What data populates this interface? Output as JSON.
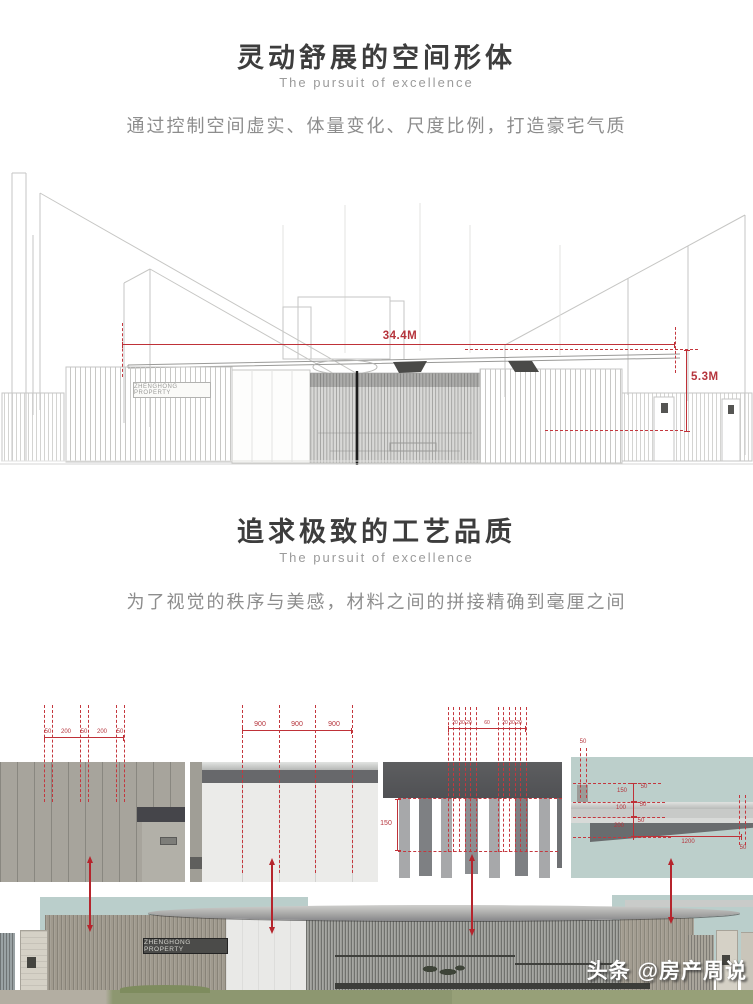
{
  "sections": [
    {
      "title": "灵动舒展的空间形体",
      "subtitle": "The pursuit of excellence",
      "description": "通过控制空间虚实、体量变化、尺度比例，打造豪宅气质"
    },
    {
      "title": "追求极致的工艺品质",
      "subtitle": "The pursuit of excellence",
      "description": "为了视觉的秩序与美感，材料之间的拼接精确到毫厘之间"
    }
  ],
  "figure1": {
    "sign": "ZHENGHONG PROPERTY",
    "dim_width": "34.4M",
    "dim_height": "5.3M"
  },
  "figure2": {
    "panel1_dims": [
      "50",
      "200",
      "50",
      "200",
      "50"
    ],
    "panel2_dims": [
      "900",
      "900",
      "900"
    ],
    "panel3_dims_top": [
      "20 30 20",
      "60",
      "20 30 20"
    ],
    "panel3_dim_height": "150",
    "panel4_dims": {
      "top": "50",
      "h1": "150",
      "s1": "50",
      "h2": "100",
      "s2": "50",
      "h3": "200",
      "s3": "50",
      "w": "1200",
      "b": "50"
    }
  },
  "elevation": {
    "sign": "ZHENGHONG PROPERTY"
  },
  "watermark": {
    "brand": "头条",
    "handle": "@房产周说"
  },
  "colors": {
    "dim_red": "#bf3138",
    "sky": "#bacecb"
  }
}
